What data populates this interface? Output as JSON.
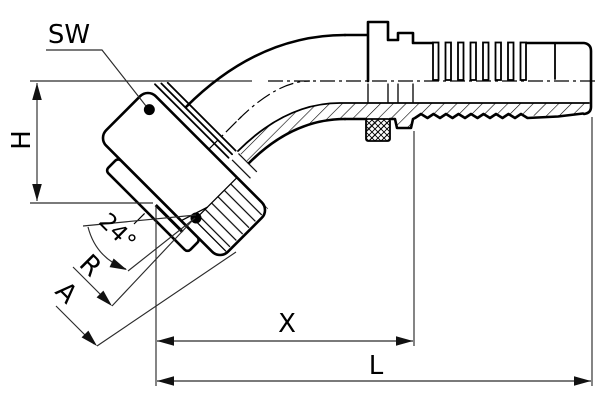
{
  "drawing": {
    "labels": {
      "sw": "SW",
      "h": "H",
      "cone_angle": "24°",
      "r": "R",
      "a": "A",
      "x": "X",
      "l": "L"
    },
    "colors": {
      "line": "#000000",
      "dimension": "#2b2b2b",
      "background": "#ffffff"
    }
  }
}
